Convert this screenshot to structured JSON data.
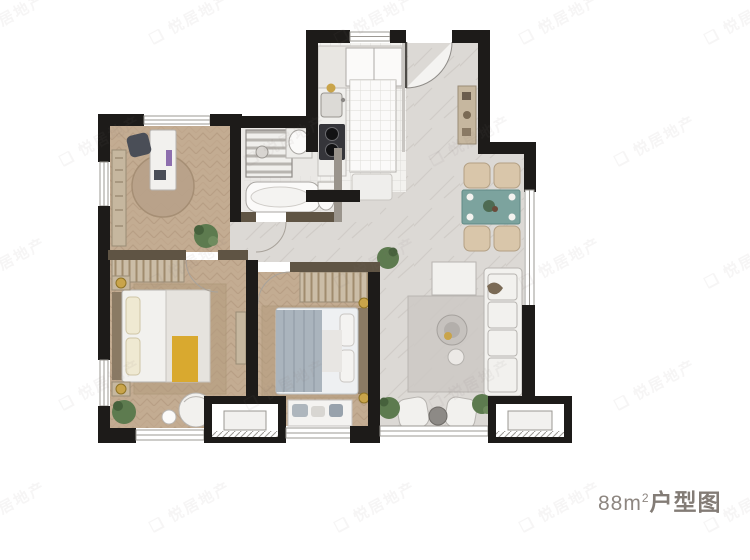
{
  "caption": {
    "area": "88m",
    "area_exp": "2",
    "name": "户型图"
  },
  "watermark": {
    "logo": "❑",
    "text": "悦居地产"
  },
  "palette": {
    "wall": "#1d1b19",
    "wood_floor": "#c3ac92",
    "marble_floor": "#dcd9d5",
    "dining_table_teal": "#7ca39e",
    "accent_gold": "#c9a44a",
    "plant_green": "#5d7b4f",
    "bed_throw_yellow": "#d9a92f",
    "bed_blanket_blue": "#aab4bd",
    "caption_gray": "#8d8680"
  },
  "rooms": [
    {
      "id": "study",
      "floor": "herringbone-wood"
    },
    {
      "id": "bathroom",
      "floor": "light-tile"
    },
    {
      "id": "kitchen",
      "floor": "white-grid-tile"
    },
    {
      "id": "foyer",
      "floor": "marble"
    },
    {
      "id": "dining",
      "floor": "marble"
    },
    {
      "id": "living",
      "floor": "marble"
    },
    {
      "id": "bedroom-master",
      "floor": "herringbone-wood"
    },
    {
      "id": "bedroom-second",
      "floor": "herringbone-wood"
    },
    {
      "id": "ac-platform-left",
      "floor": "none"
    },
    {
      "id": "ac-platform-right",
      "floor": "none"
    }
  ]
}
